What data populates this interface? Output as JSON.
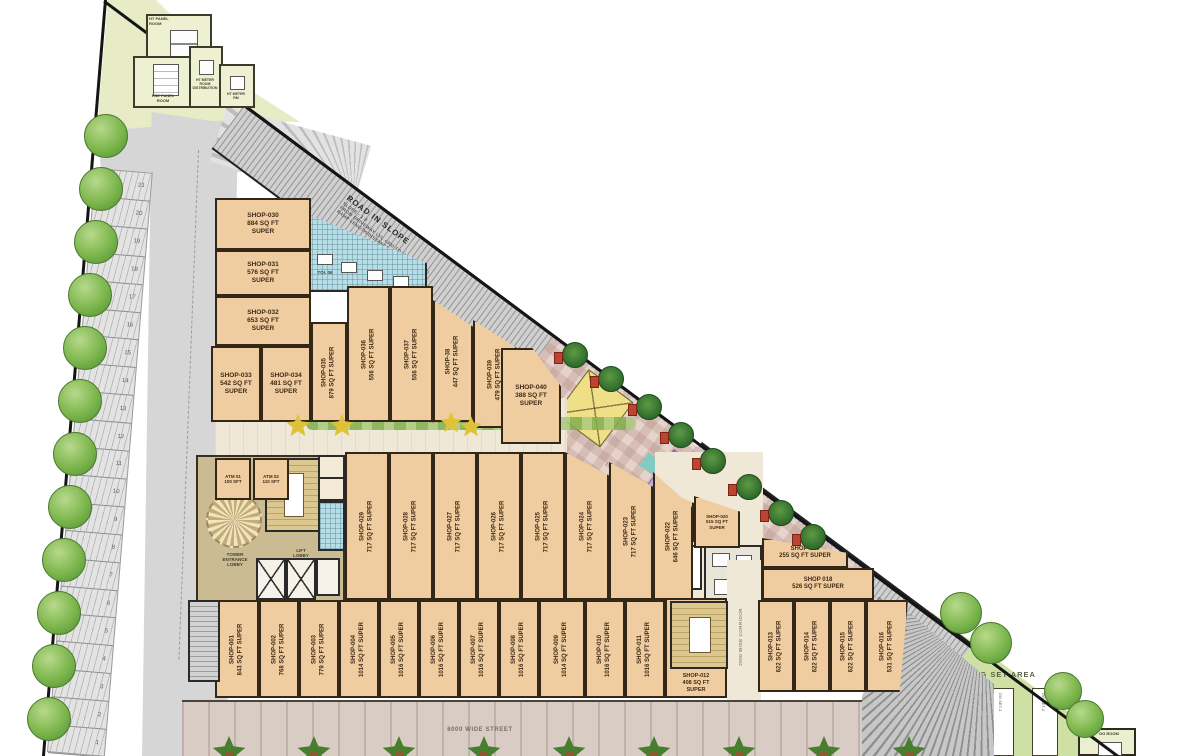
{
  "colors": {
    "shop": "#f0cda0",
    "wall": "#332718",
    "road": "#d2d2d2",
    "cream": "#efe8d6",
    "khaki": "#cbbb92",
    "green": "#cfe0a5",
    "plaza": "#e6d3cc",
    "street": "#d8ccc5"
  },
  "shops": [
    {
      "id": "shop-001",
      "name": "SHOP-001",
      "area": "843 SQ FT",
      "suffix": "SUPER"
    },
    {
      "id": "shop-002",
      "name": "SHOP-002",
      "area": "768 SQ FT",
      "suffix": "SUPER"
    },
    {
      "id": "shop-003",
      "name": "SHOP-003",
      "area": "779 SQ FT",
      "suffix": "SUPER"
    },
    {
      "id": "shop-004",
      "name": "SHOP-004",
      "area": "1014 SQ FT",
      "suffix": "SUPER"
    },
    {
      "id": "shop-005",
      "name": "SHOP-005",
      "area": "1016 SQ FT",
      "suffix": "SUPER"
    },
    {
      "id": "shop-006",
      "name": "SHOP-006",
      "area": "1016 SQ FT",
      "suffix": "SUPER"
    },
    {
      "id": "shop-007",
      "name": "SHOP-007",
      "area": "1016 SQ FT",
      "suffix": "SUPER"
    },
    {
      "id": "shop-008",
      "name": "SHOP-008",
      "area": "1016 SQ FT",
      "suffix": "SUPER"
    },
    {
      "id": "shop-009",
      "name": "SHOP-009",
      "area": "1014 SQ FT",
      "suffix": "SUPER"
    },
    {
      "id": "shop-010",
      "name": "SHOP-010",
      "area": "1016 SQ FT",
      "suffix": "SUPER"
    },
    {
      "id": "shop-011",
      "name": "SHOP-011",
      "area": "1016 SQ FT",
      "suffix": "SUPER"
    },
    {
      "id": "shop-012",
      "name": "SHOP-012",
      "area": "408 SQ FT",
      "suffix": "SUPER"
    },
    {
      "id": "shop-013",
      "name": "SHOP-013",
      "area": "622 SQ FT",
      "suffix": "SUPER"
    },
    {
      "id": "shop-014",
      "name": "SHOP-014",
      "area": "622 SQ FT",
      "suffix": "SUPER"
    },
    {
      "id": "shop-015",
      "name": "SHOP-015",
      "area": "622 SQ FT",
      "suffix": "SUPER"
    },
    {
      "id": "shop-016",
      "name": "SHOP-016",
      "area": "531 SQ FT",
      "suffix": "SUPER"
    },
    {
      "id": "shop-018",
      "name": "SHOP 018",
      "area": "526 SQ FT",
      "suffix": "SUPER"
    },
    {
      "id": "shop-019",
      "name": "SHOP-019",
      "area": "255 SQ FT",
      "suffix": "SUPER"
    },
    {
      "id": "shop-020",
      "name": "SHOP-020",
      "area": "515 SQ FT",
      "suffix": "SUPER"
    },
    {
      "id": "shop-021",
      "name": "SHOP-021",
      "area": "208 SQFT",
      "suffix": "SUPER"
    },
    {
      "id": "shop-022",
      "name": "SHOP-022",
      "area": "646 SQ FT",
      "suffix": "SUPER"
    },
    {
      "id": "shop-023",
      "name": "SHOP-023",
      "area": "717 SQ FT",
      "suffix": "SUPER"
    },
    {
      "id": "shop-024",
      "name": "SHOP-024",
      "area": "717 SQ FT",
      "suffix": "SUPER"
    },
    {
      "id": "shop-025",
      "name": "SHOP-025",
      "area": "717 SQ FT",
      "suffix": "SUPER"
    },
    {
      "id": "shop-026",
      "name": "SHOP-026",
      "area": "717 SQ FT",
      "suffix": "SUPER"
    },
    {
      "id": "shop-027",
      "name": "SHOP-027",
      "area": "717 SQ FT",
      "suffix": "SUPER"
    },
    {
      "id": "shop-028",
      "name": "SHOP-028",
      "area": "717 SQ FT",
      "suffix": "SUPER"
    },
    {
      "id": "shop-029",
      "name": "SHOP-029",
      "area": "717 SQ FT",
      "suffix": "SUPER"
    },
    {
      "id": "shop-030",
      "name": "SHOP-030",
      "area": "884 SQ FT",
      "suffix": "SUPER"
    },
    {
      "id": "shop-031",
      "name": "SHOP-031",
      "area": "576 SQ FT",
      "suffix": "SUPER"
    },
    {
      "id": "shop-032",
      "name": "SHOP-032",
      "area": "653 SQ FT",
      "suffix": "SUPER"
    },
    {
      "id": "shop-033",
      "name": "SHOP-033",
      "area": "542 SQ FT",
      "suffix": "SUPER"
    },
    {
      "id": "shop-034",
      "name": "SHOP-034",
      "area": "481 SQ FT",
      "suffix": "SUPER"
    },
    {
      "id": "shop-035",
      "name": "SHOP-035",
      "area": "879 SQ FT",
      "suffix": "SUPER"
    },
    {
      "id": "shop-036",
      "name": "SHOP-036",
      "area": "556 SQ FT",
      "suffix": "SUPER"
    },
    {
      "id": "shop-037",
      "name": "SHOP-037",
      "area": "556 SQ FT",
      "suffix": "SUPER"
    },
    {
      "id": "shop-038",
      "name": "SHOP-38",
      "area": "447 SQ FT",
      "suffix": "SUPER"
    },
    {
      "id": "shop-039",
      "name": "SHOP-039",
      "area": "479 SQ FT",
      "suffix": "SUPER"
    },
    {
      "id": "shop-040",
      "name": "SHOP-040",
      "area": "388 SQ FT",
      "suffix": "SUPER"
    }
  ],
  "parking": {
    "numbers": [
      "21",
      "20",
      "19",
      "18",
      "17",
      "16",
      "15",
      "14",
      "13",
      "12",
      "11",
      "10",
      "9",
      "8",
      "7",
      "6",
      "5",
      "4",
      "3",
      "2",
      "1"
    ]
  },
  "roads": {
    "top": {
      "title": "ROAD IN SLOPE",
      "line1": "SLOPE - 1:8",
      "line2": "FROM DRIVEWAY LVL +300 TO LVL (+4.70 M)",
      "line3": "RAMP LENGTH/DISTANCE 36.00 M"
    },
    "right": {
      "title": "ROAD IN SLOPE",
      "line1": "SLOPE - 1:8",
      "line2": "FROM LVL +14.70 M TO DRIVEWAY LVL +300",
      "line3": "RAMP LENGTH 36.00 M"
    },
    "driveway_note": "DRIVEWAY LVL +300"
  },
  "streets": {
    "shopping": "40'0 WIDE SHOPPING STREET",
    "bottom": "6000 WIDE STREET"
  },
  "corridors": {
    "c1800": "1800 WIDE CORRIDOR",
    "c2500": "2500 WIDE CORRIDOR"
  },
  "lobby": {
    "tower": "TOWER\nENTRANCE\nLOBBY",
    "lift": "LIFT\nLOBBY"
  },
  "atms": [
    {
      "name": "ATM 01",
      "area": "100 SFT"
    },
    {
      "name": "ATM 02",
      "area": "110 SFT"
    }
  ],
  "toilet": "TOI. 06",
  "serv": "SERV.",
  "dg": {
    "area_label": "DG SET AREA",
    "sets": [
      "DG SET-1",
      "DG SET-2"
    ],
    "room": "DG ROOM"
  },
  "utility": {
    "rooms": [
      {
        "label": "HT PANEL\nROOM"
      },
      {
        "label": "HSE PANEL\nROOM"
      },
      {
        "label": "HT METER\nROOM\nDISTRIBUTION"
      },
      {
        "label": "HT METER\nRM"
      }
    ]
  }
}
